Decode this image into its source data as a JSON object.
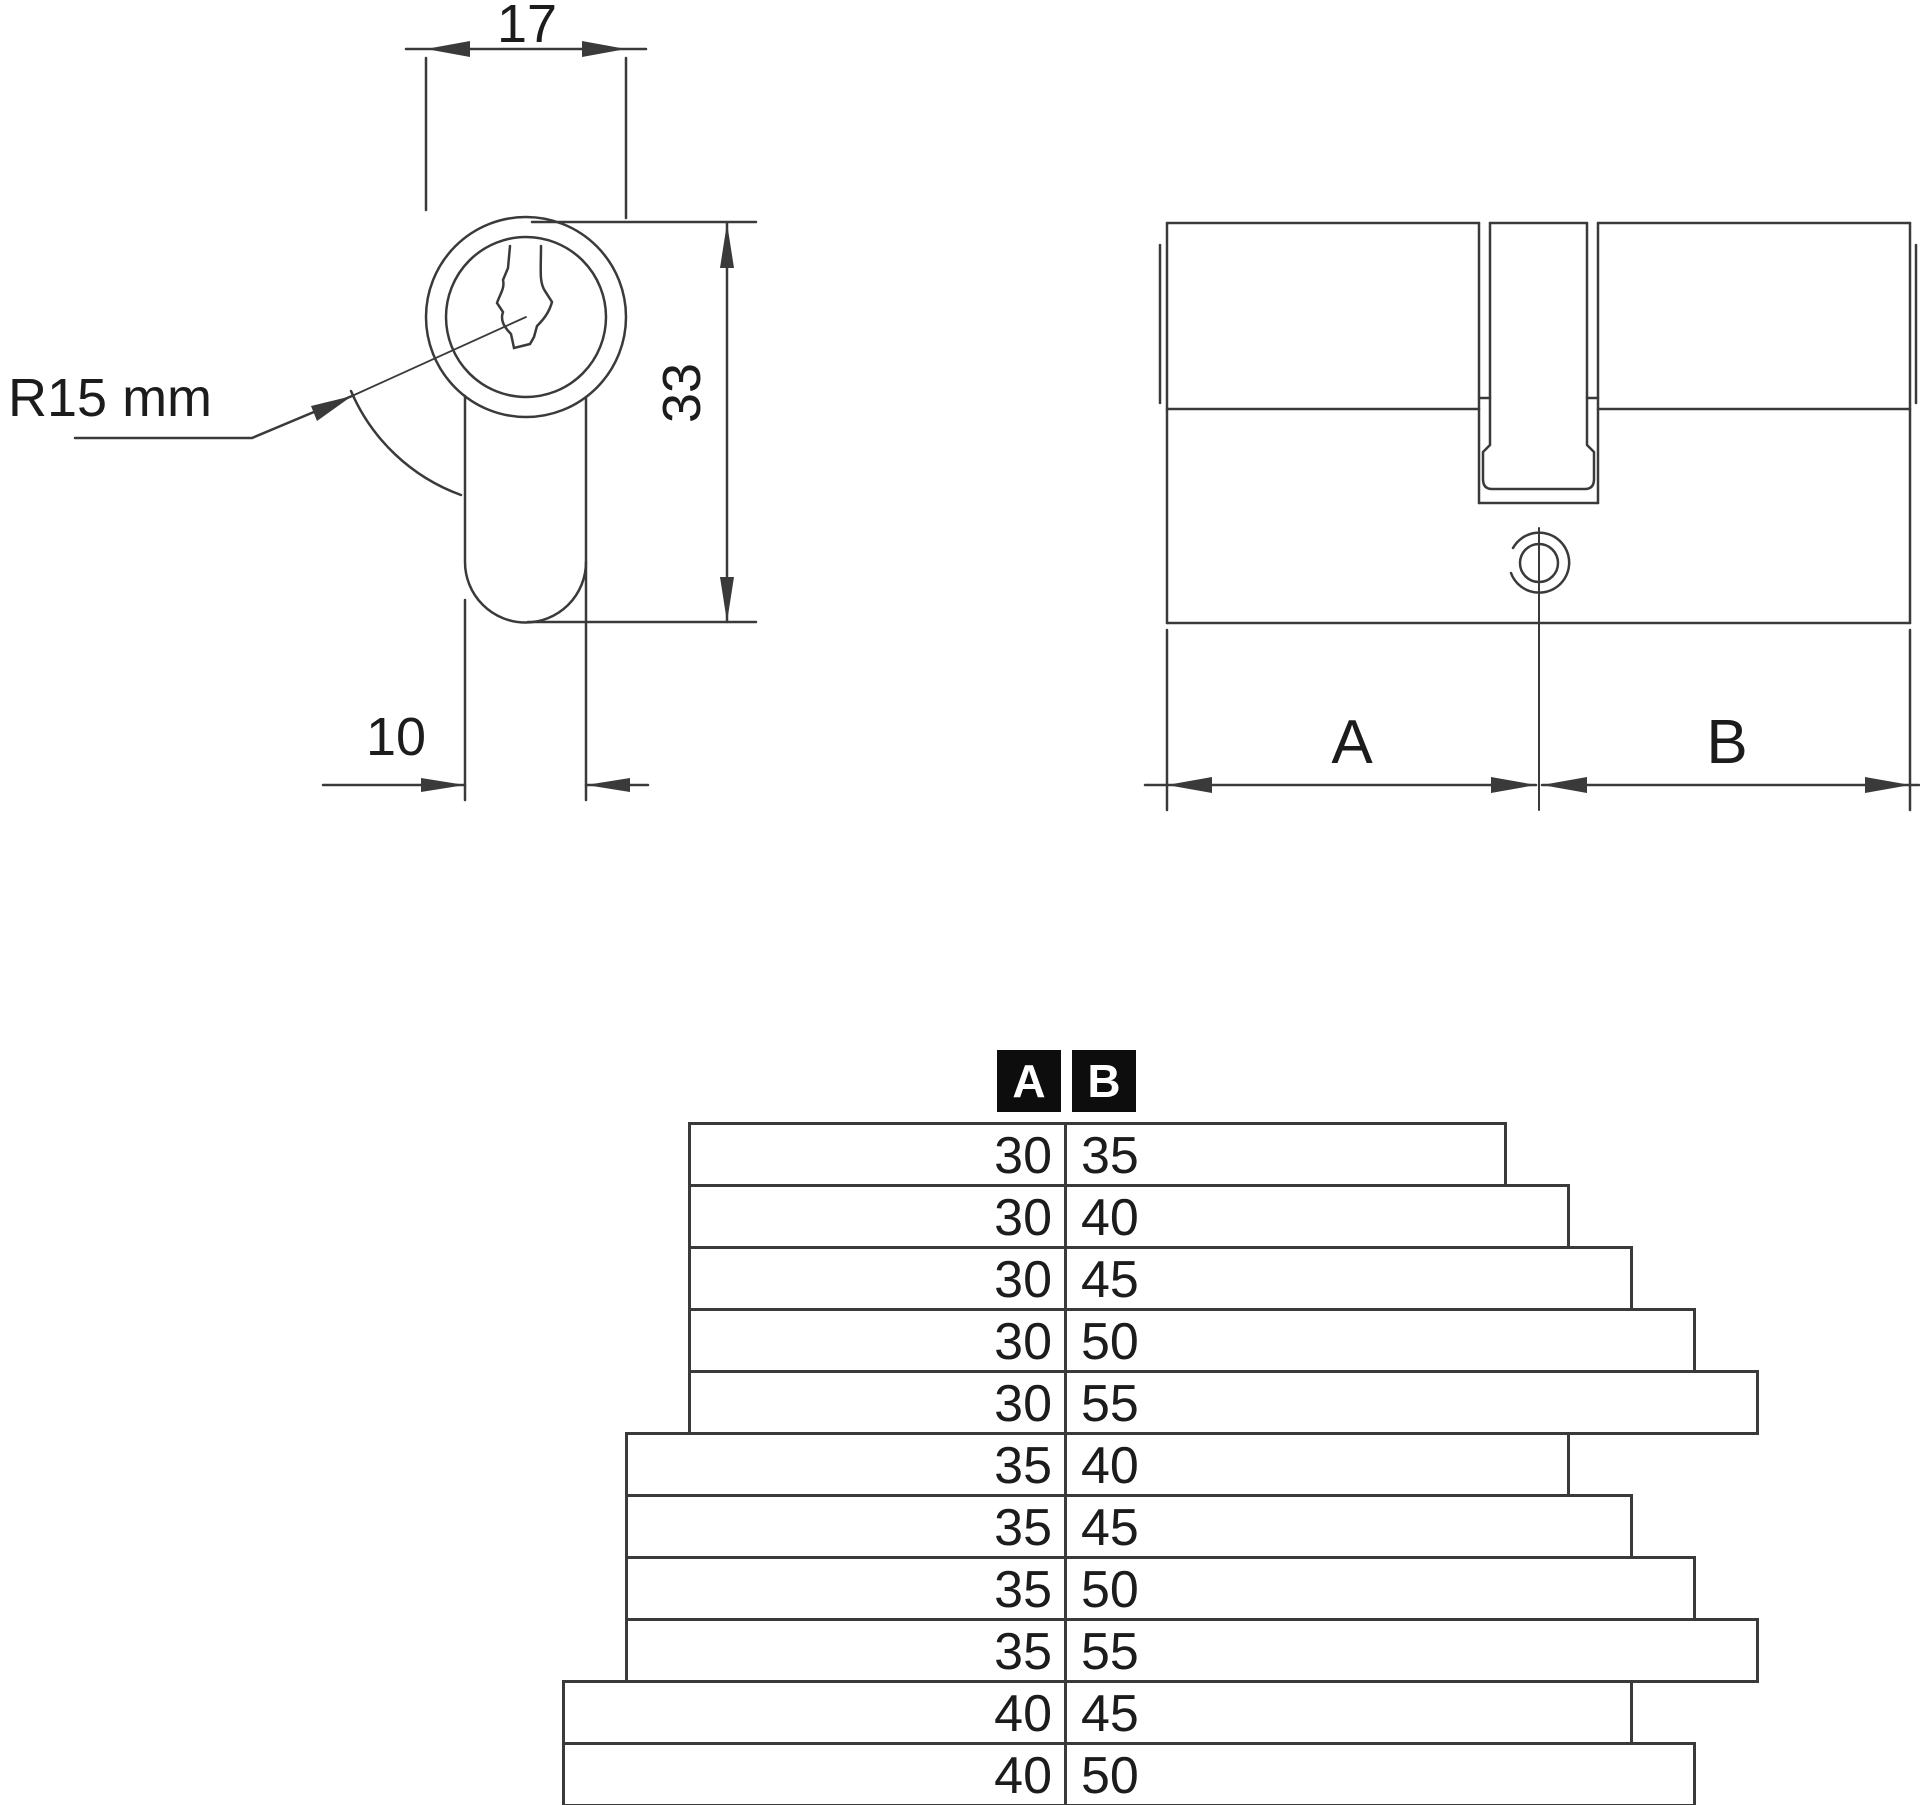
{
  "front_view": {
    "dim_width": "17",
    "dim_height": "33",
    "dim_tail_width": "10",
    "radius_label": "R15 mm"
  },
  "side_view": {
    "dim_a_label": "A",
    "dim_b_label": "B"
  },
  "table": {
    "header": {
      "a": "A",
      "b": "B"
    },
    "rows": [
      {
        "a": 30,
        "b": 35
      },
      {
        "a": 30,
        "b": 40
      },
      {
        "a": 30,
        "b": 45
      },
      {
        "a": 30,
        "b": 50
      },
      {
        "a": 30,
        "b": 55
      },
      {
        "a": 35,
        "b": 40
      },
      {
        "a": 35,
        "b": 45
      },
      {
        "a": 35,
        "b": 50
      },
      {
        "a": 35,
        "b": 55
      },
      {
        "a": 40,
        "b": 45
      },
      {
        "a": 40,
        "b": 50
      }
    ]
  },
  "colors": {
    "line": "#3a3a3a",
    "text": "#1c1c1c",
    "header_bg": "#0d0d0d",
    "header_fg": "#ffffff",
    "background": "#ffffff"
  }
}
